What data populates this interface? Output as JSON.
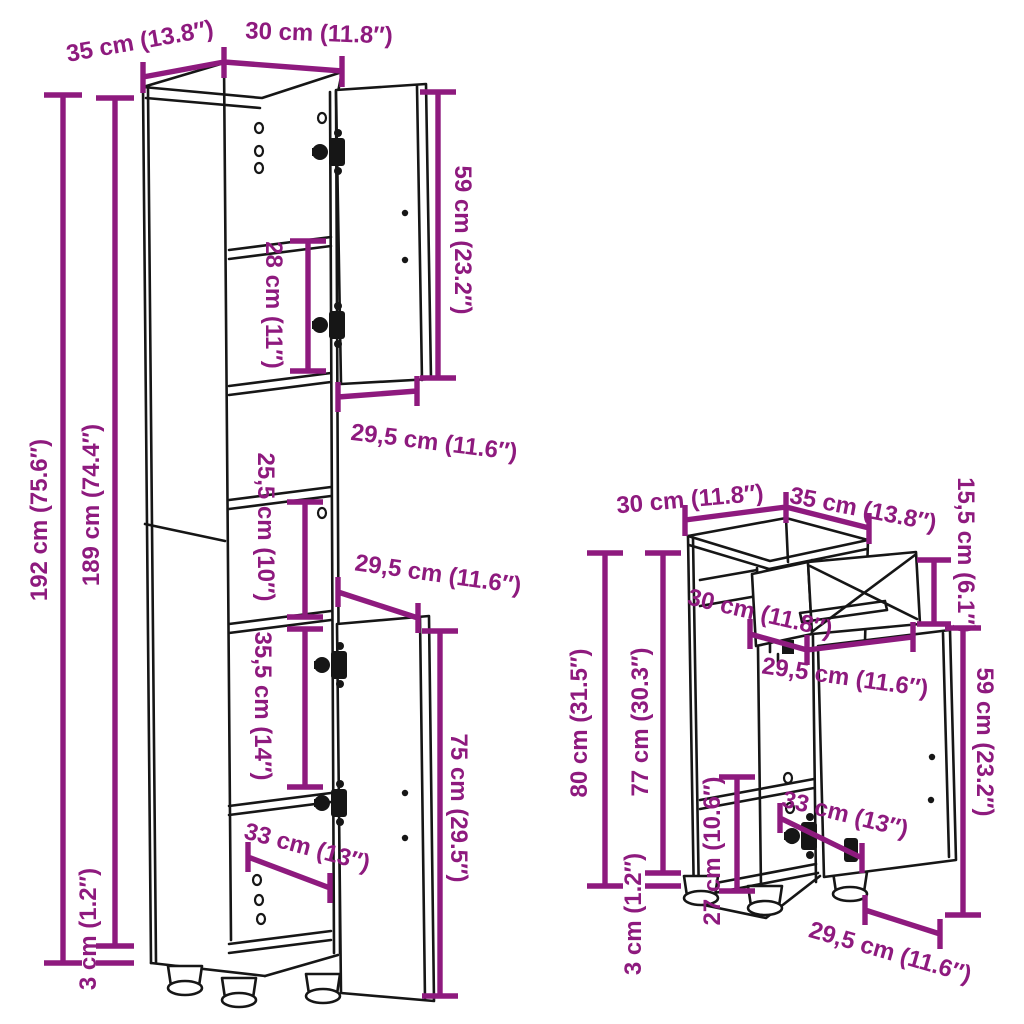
{
  "theme": {
    "dimension_color": "#8E1A7E",
    "line_color": "#161616",
    "background": "#FFFFFF"
  },
  "tall_cabinet": {
    "top_depth": "35 cm (13.8″)",
    "top_width": "30 cm (11.8″)",
    "total_height": "192 cm (75.6″)",
    "carcass_height": "189 cm (74.4″)",
    "upper_compartment_height": "28 cm (11″)",
    "upper_door_height": "59 cm (23.2″)",
    "upper_door_width": "29,5 cm (11.6″)",
    "middle_compartment_height": "25,5 cm (10″)",
    "lower_door_width": "29,5 cm (11.6″)",
    "lower_compartment_height": "35,5 cm (14″)",
    "interior_width": "33 cm (13″)",
    "lower_door_height": "75 cm (29.5″)",
    "foot_height": "3 cm (1.2″)"
  },
  "small_cabinet": {
    "top_width": "30 cm (11.8″)",
    "top_depth": "35 cm (13.8″)",
    "drawer_height": "15,5 cm (6.1″)",
    "drawer_depth": "30 cm (11.8″)",
    "drawer_width": "29,5 cm (11.6″)",
    "total_height": "80 cm (31.5″)",
    "carcass_height": "77 cm (30.3″)",
    "shelf_compartment_height": "27 cm (10.6″)",
    "interior_width": "33 cm (13″)",
    "door_height": "59 cm (23.2″)",
    "foot_height": "3 cm (1.2″)",
    "door_width": "29,5 cm (11.6″)"
  }
}
